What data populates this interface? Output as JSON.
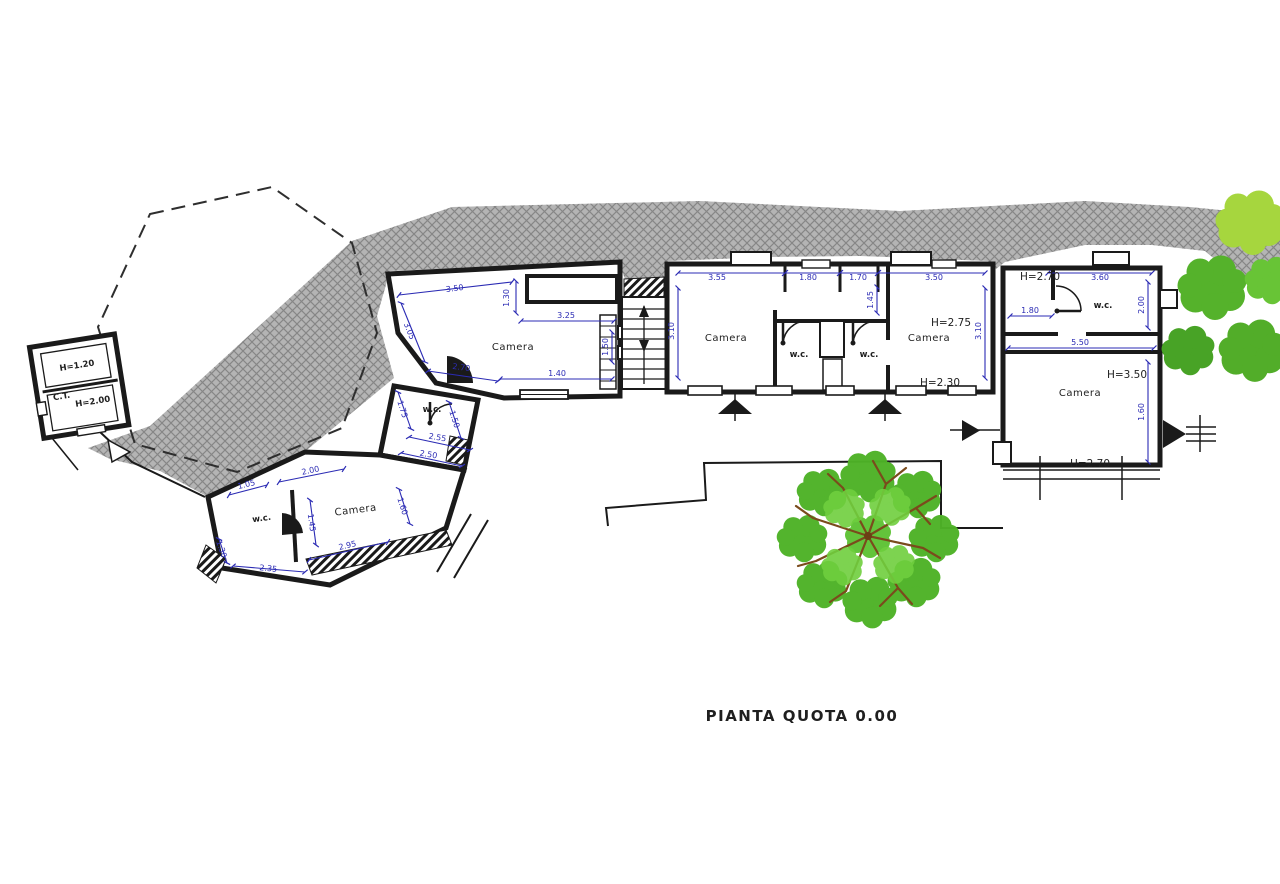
{
  "drawing": {
    "title": "PIANTA QUOTA 0.00",
    "colors": {
      "dimension": "#2b2bb4",
      "wall": "#1a1a1a",
      "terrain_hatch": "#b4b4b4",
      "tree_green": "#4eb227",
      "tree_light_green": "#a6d63e",
      "branch_brown": "#7a4b1c"
    },
    "outbuilding": {
      "h_top": "H=1.20",
      "name": "C.T.",
      "h_bottom": "H=2.00"
    },
    "left_wing": {
      "camera": "Camera",
      "wc": "w.c.",
      "dim_top": "3.50",
      "dim_top_v": "1.30",
      "dim_inner": "3.25",
      "dim_left": "3.05",
      "dim_bottom_slant": "2.70",
      "dim_bottom": "1.40",
      "dim_right_v": "1.50",
      "wc_dim_left": "1.75",
      "wc_dim_right": "1.50",
      "wc_dim_a": "2.55",
      "wc_dim_b": "2.50"
    },
    "lower_wing": {
      "wc": "w.c.",
      "camera": "Camera",
      "dim_a": "1.05",
      "dim_b": "2.00",
      "dim_mid_v": "1.45",
      "dim_left_v": "1.30",
      "dim_bottom_a": "2.35",
      "dim_bottom_b": "2.95",
      "dim_right_v": "1.60"
    },
    "middle_building": {
      "camera_left": "Camera",
      "wc_left": "w.c.",
      "wc_right": "w.c.",
      "camera_right": "Camera",
      "h_right": "H=2.75",
      "h_bottom": "H=2.30",
      "dim_1": "3.55",
      "dim_2": "1.80",
      "dim_3": "1.70",
      "dim_4": "3.50",
      "dim_left_v": "3.10",
      "dim_right_v": "3.10",
      "dim_wc_v": "1.45"
    },
    "right_building": {
      "wc": "w.c.",
      "camera": "Camera",
      "h_wc": "H=2.70",
      "h_camera": "H=3.50",
      "h_bottom": "H=2.70",
      "dim_top": "3.60",
      "dim_wc": "1.80",
      "dim_right_v": "2.00",
      "dim_mid": "5.50",
      "dim_camera_v": "1.60"
    }
  }
}
